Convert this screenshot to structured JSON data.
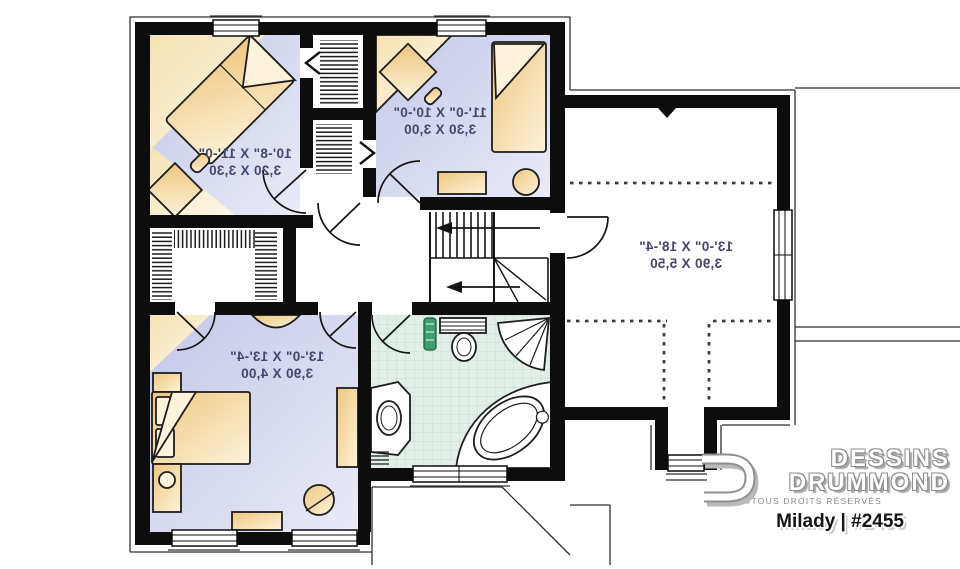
{
  "plan": {
    "rooms": [
      {
        "id": "bedroom-upper-left",
        "imperial": "10'-8\" X 11'-0\"",
        "metric": "3,20 X 3,30"
      },
      {
        "id": "bedroom-upper-mid",
        "imperial": "11'-0\" X 10'-0\"",
        "metric": "3,30 X 3,00"
      },
      {
        "id": "master-bedroom",
        "imperial": "13'-0\" X 13'-4\"",
        "metric": "3,90 X 4,00"
      },
      {
        "id": "bonus-room",
        "imperial": "13'-0\" X 18'-4\"",
        "metric": "3,90 X 5,50"
      }
    ]
  },
  "branding": {
    "company_line1": "DESSINS",
    "company_line2": "DRUMMOND",
    "rights": "©TOUS DROITS RÉSERVÉS",
    "caption": "Milady | #2455"
  },
  "icons": {
    "logo_mark": "drummond-d-logo",
    "stair_arrows": "left-arrow"
  },
  "colors": {
    "wall": "#0d0d0d",
    "floor": "#c9cee9",
    "furniture": "#f2cd8a",
    "bath_floor": "#e1efe6",
    "dimension_text": "#45466b"
  }
}
